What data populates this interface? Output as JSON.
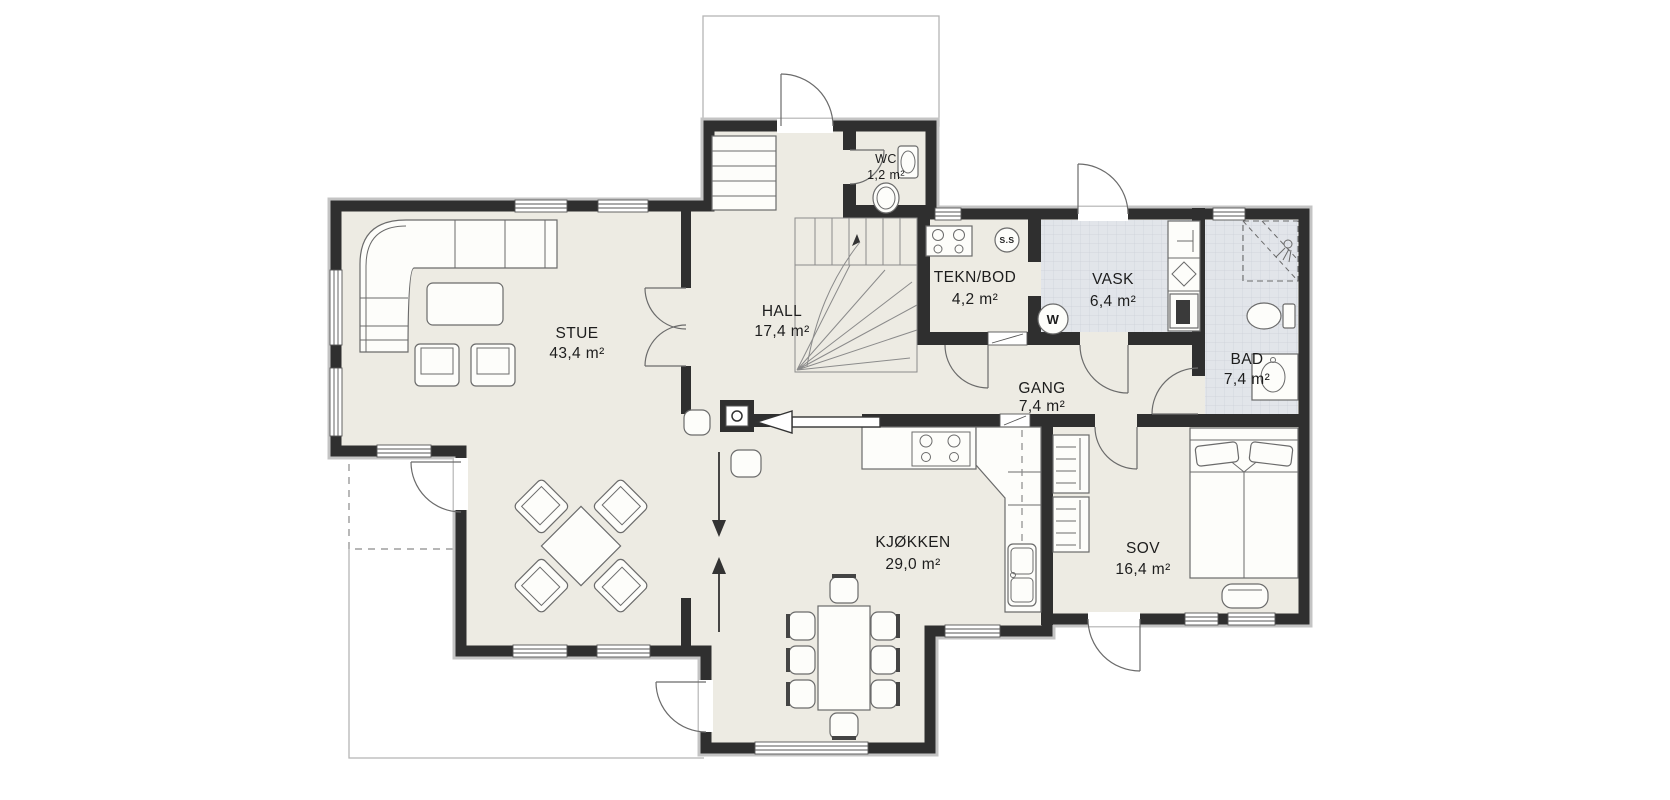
{
  "plan": {
    "type": "floor-plan",
    "colors": {
      "wall": "#2f2f2f",
      "floor": "#edebe3",
      "tile": "#e2e5ea",
      "outline": "#c4c4c4"
    },
    "rooms": [
      {
        "name": "STUE",
        "area": "43,4 m²"
      },
      {
        "name": "HALL",
        "area": "17,4 m²"
      },
      {
        "name": "WC",
        "area": "1,2 m²"
      },
      {
        "name": "TEKN/BOD",
        "area": "4,2 m²"
      },
      {
        "name": "VASK",
        "area": "6,4 m²"
      },
      {
        "name": "BAD",
        "area": "7,4 m²"
      },
      {
        "name": "GANG",
        "area": "7,4 m²"
      },
      {
        "name": "KJØKKEN",
        "area": "29,0 m²"
      },
      {
        "name": "SOV",
        "area": "16,4 m²"
      }
    ],
    "appliance_labels": {
      "ss_mark": "S.S",
      "washer": "W"
    }
  }
}
